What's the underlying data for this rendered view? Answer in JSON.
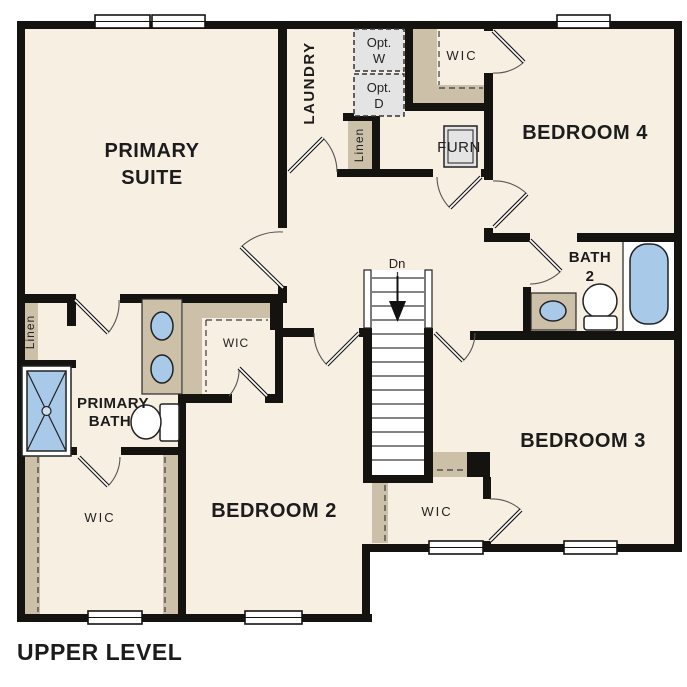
{
  "title": "UPPER LEVEL",
  "colors": {
    "cream": "#f7efe2",
    "tan": "#cdc0a8",
    "blue": "#a9c9e9",
    "gray": "#e4e4e4",
    "wall": "#151310"
  },
  "rooms": {
    "primary_suite": {
      "line1": "PRIMARY",
      "line2": "SUITE"
    },
    "laundry": {
      "label": "LAUNDRY"
    },
    "opt_washer": {
      "line1": "Opt.",
      "line2": "W"
    },
    "opt_dryer": {
      "line1": "Opt.",
      "line2": "D"
    },
    "wic": {
      "label": "WIC"
    },
    "bedroom4": {
      "label": "BEDROOM 4"
    },
    "furnace": {
      "label": "FURN"
    },
    "linen": {
      "label": "Linen"
    },
    "bath2": {
      "line1": "BATH",
      "line2": "2"
    },
    "bedroom3": {
      "label": "BEDROOM 3"
    },
    "bedroom2": {
      "label": "BEDROOM 2"
    },
    "primary_bath": {
      "line1": "PRIMARY",
      "line2": "BATH"
    },
    "stairs": {
      "direction": "Dn"
    }
  }
}
